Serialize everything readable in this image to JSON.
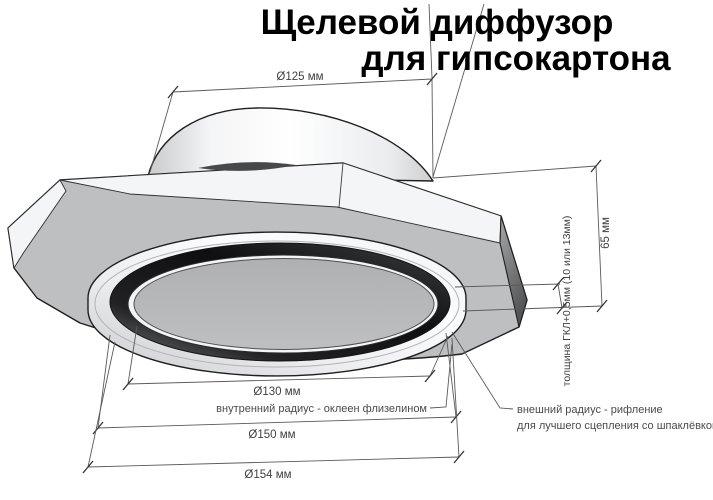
{
  "title": {
    "line1": "Щелевой диффузор",
    "line2": "для гипсокартона"
  },
  "dimensions": {
    "collar_diameter": "Ø125 мм",
    "inner_diameter": "Ø130 мм",
    "outer_diameter": "Ø150 мм",
    "flange_diameter": "Ø154 мм",
    "height": "65 мм",
    "board_thickness": "толщина ГКЛ+0,5мм (10 или 13мм)"
  },
  "annotations": {
    "inner_radius": "внутренний радиус - оклеен флизелином",
    "outer_radius_line1": "внешний радиус - рифление",
    "outer_radius_line2": "для лучшего сцепления со шпаклёвкой"
  },
  "colors": {
    "ink": "#1f1f1f",
    "dim-line": "#5a5a5a",
    "dim-text": "#3f3f3f",
    "title-text": "#000000",
    "plate-gray": "#bdbfc1",
    "disc-gray": "#b4b6b8",
    "slot-dark": "#141416",
    "highlight-white": "#fafbfc"
  }
}
